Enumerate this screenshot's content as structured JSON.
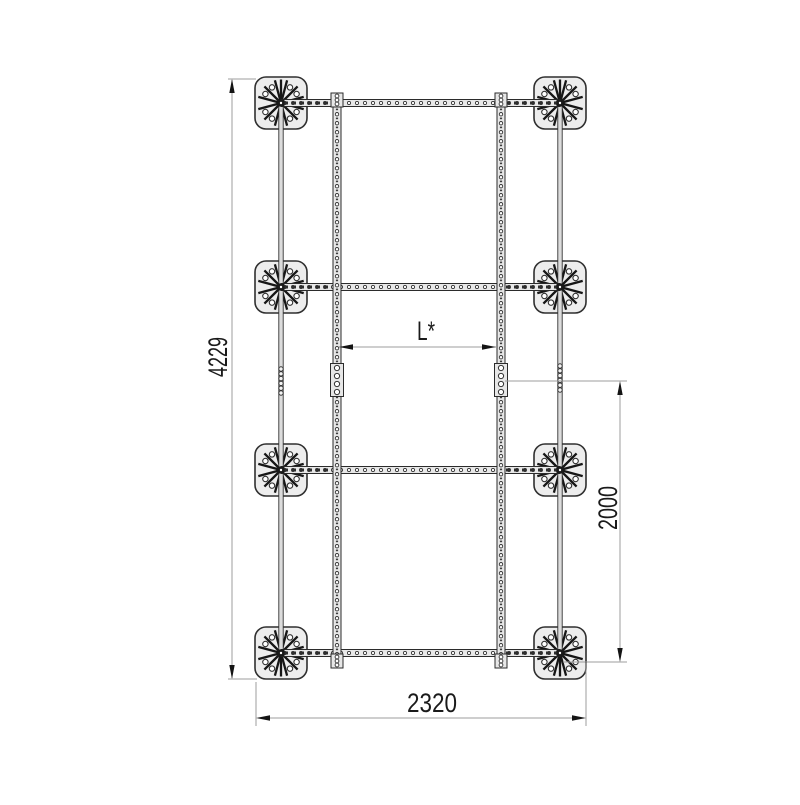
{
  "drawing": {
    "dimensions": {
      "overall_length_label": "4229",
      "overall_width_label": "2320",
      "segment_length_label": "2000",
      "rail_spacing_label": "L*"
    },
    "colors": {
      "background": "#ffffff",
      "structure_stroke": "#2b2b2b",
      "structure_fill": "#e8e8e8",
      "dimension_line": "#9c9c9c",
      "dimension_text": "#1a1a1a"
    }
  }
}
